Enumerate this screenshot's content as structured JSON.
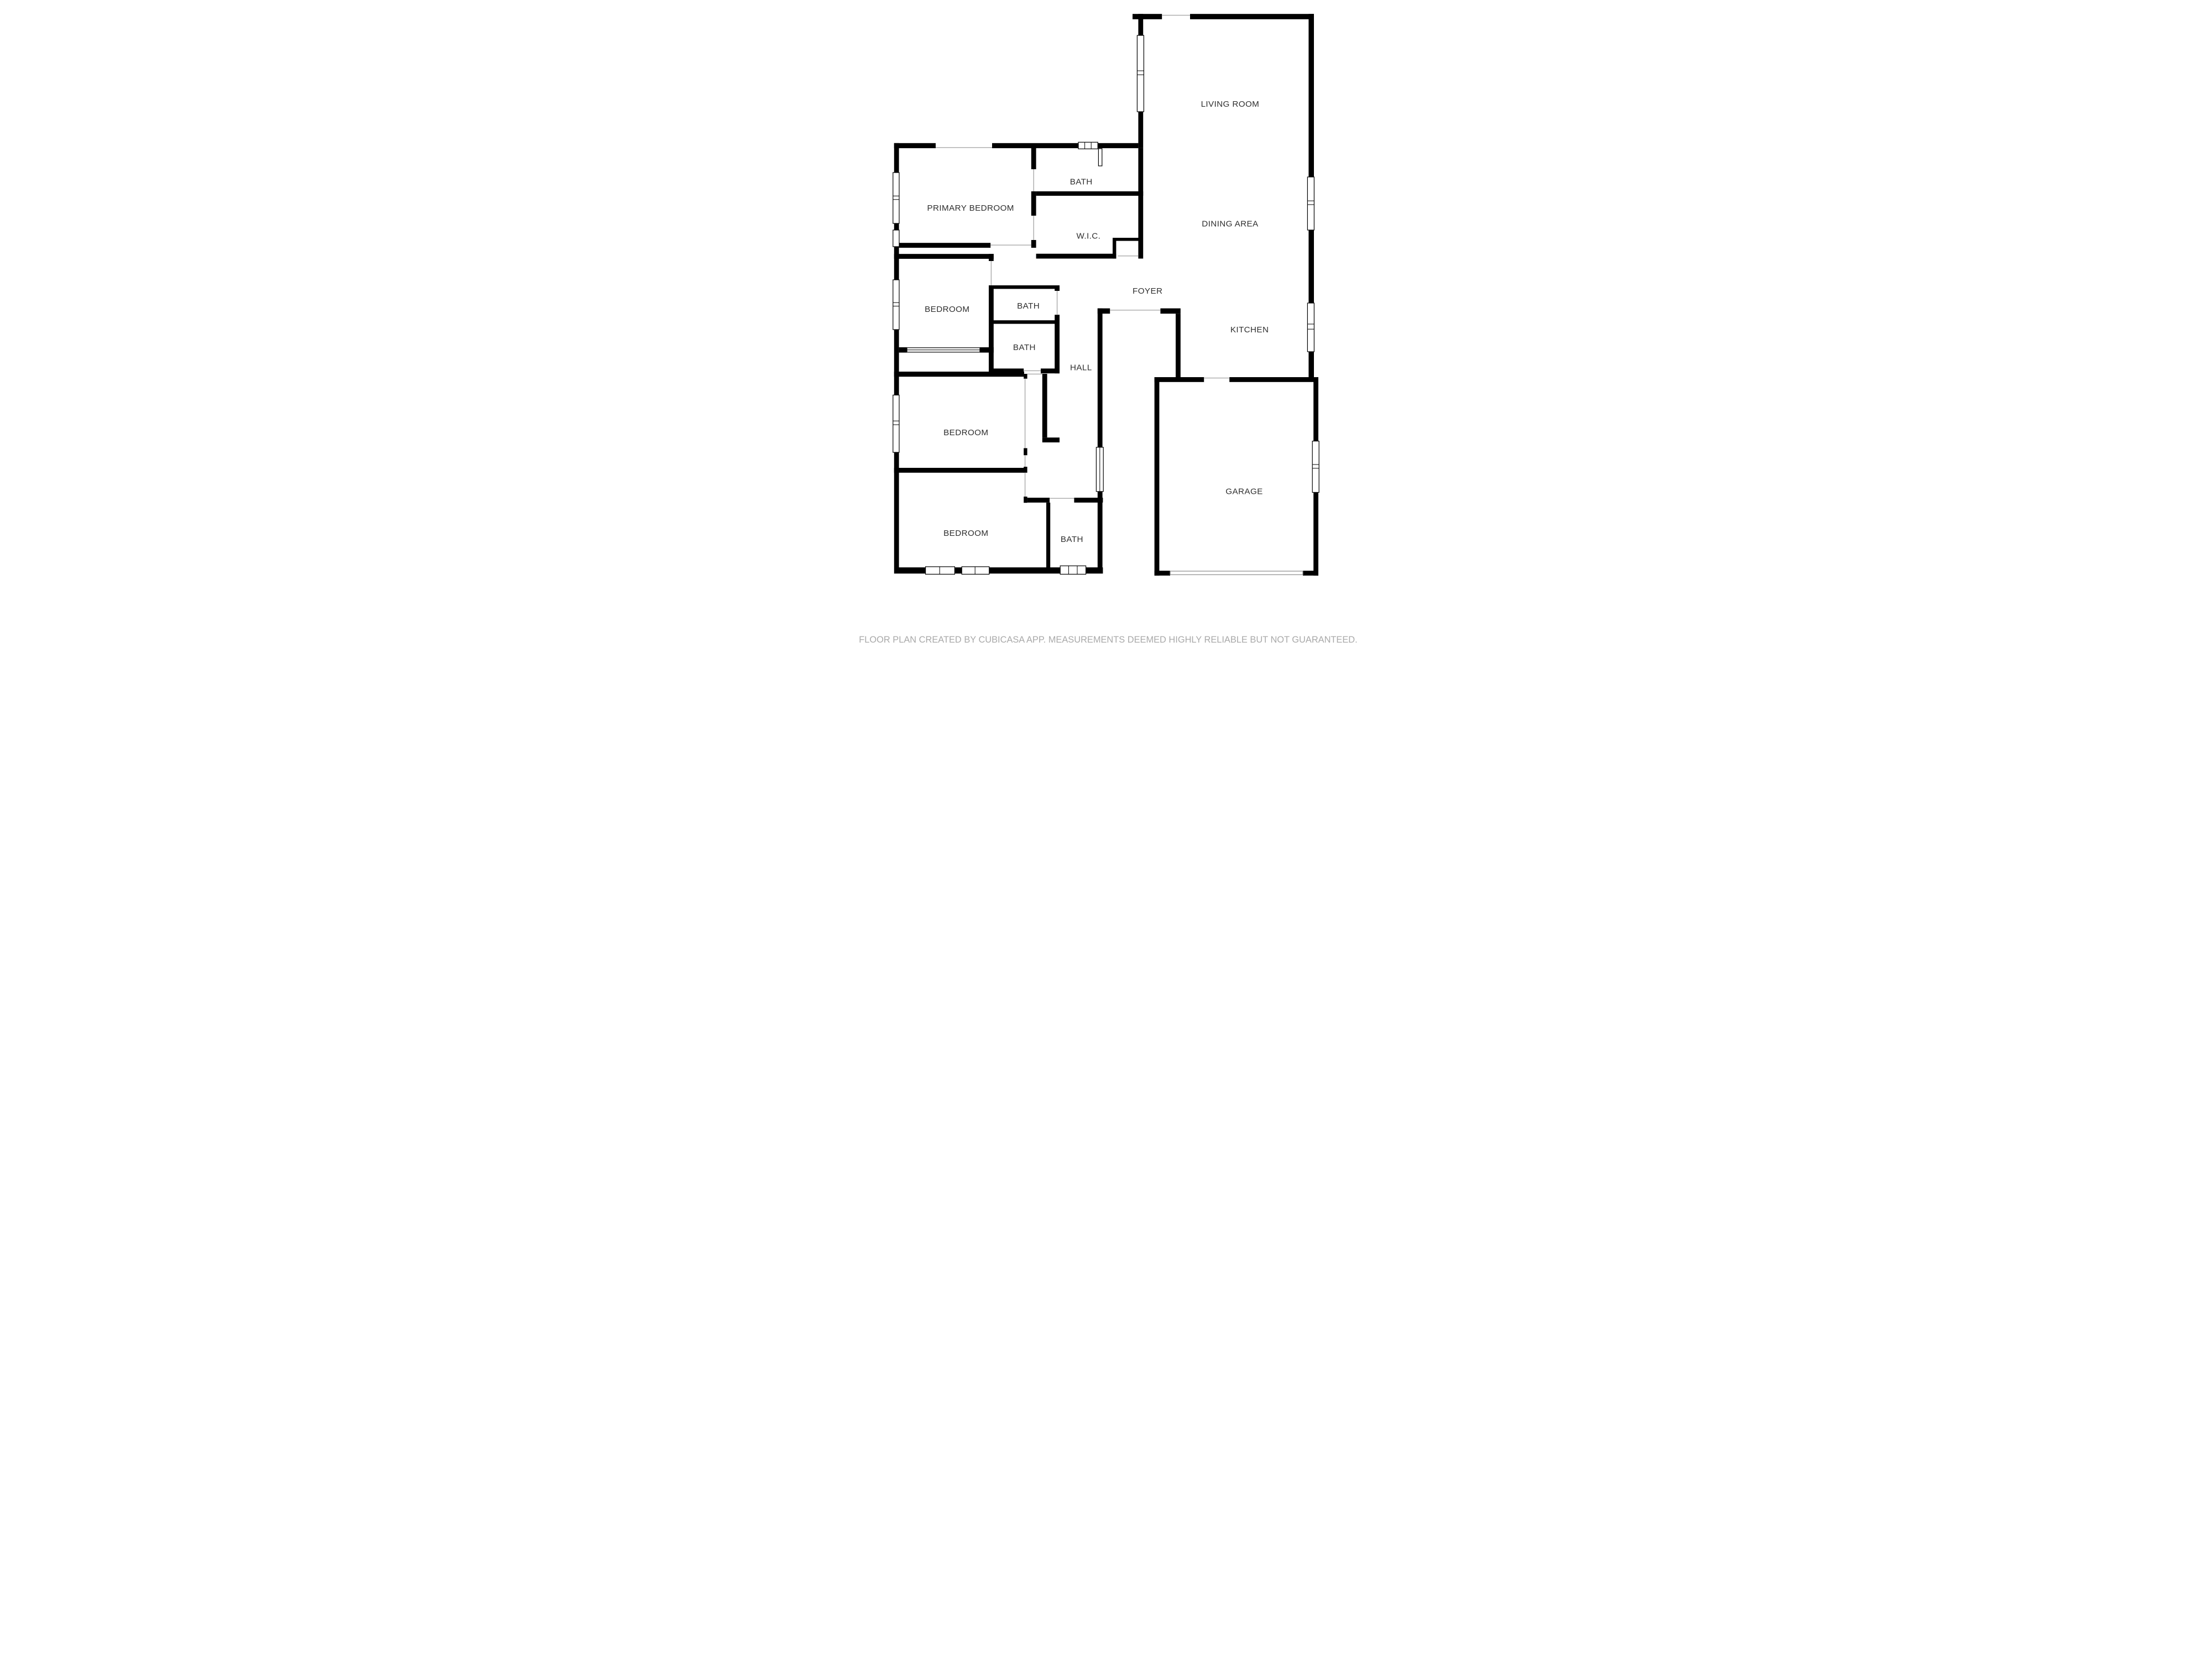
{
  "meta": {
    "app_attribution": "CubiCasa",
    "footer": "FLOOR PLAN CREATED BY CUBICASA APP. MEASUREMENTS DEEMED HIGHLY RELIABLE BUT NOT GUARANTEED."
  },
  "colors": {
    "wall": "#000000",
    "floor": "#ffffff",
    "opening_line": "#a8a8a8",
    "label_text": "#2e2e2e",
    "footer_text": "#a9a9a9"
  },
  "rooms": [
    {
      "id": "living-room",
      "label": "LIVING ROOM"
    },
    {
      "id": "bath-top",
      "label": "BATH"
    },
    {
      "id": "primary-bedroom",
      "label": "PRIMARY BEDROOM"
    },
    {
      "id": "dining-area",
      "label": "DINING AREA"
    },
    {
      "id": "wic",
      "label": "W.I.C."
    },
    {
      "id": "foyer",
      "label": "FOYER"
    },
    {
      "id": "bath-mid-upper",
      "label": "BATH"
    },
    {
      "id": "bedroom-2",
      "label": "BEDROOM"
    },
    {
      "id": "kitchen",
      "label": "KITCHEN"
    },
    {
      "id": "bath-mid-lower",
      "label": "BATH"
    },
    {
      "id": "hall",
      "label": "HALL"
    },
    {
      "id": "bedroom-3",
      "label": "BEDROOM"
    },
    {
      "id": "garage",
      "label": "GARAGE"
    },
    {
      "id": "bedroom-4",
      "label": "BEDROOM"
    },
    {
      "id": "bath-bottom",
      "label": "BATH"
    }
  ]
}
